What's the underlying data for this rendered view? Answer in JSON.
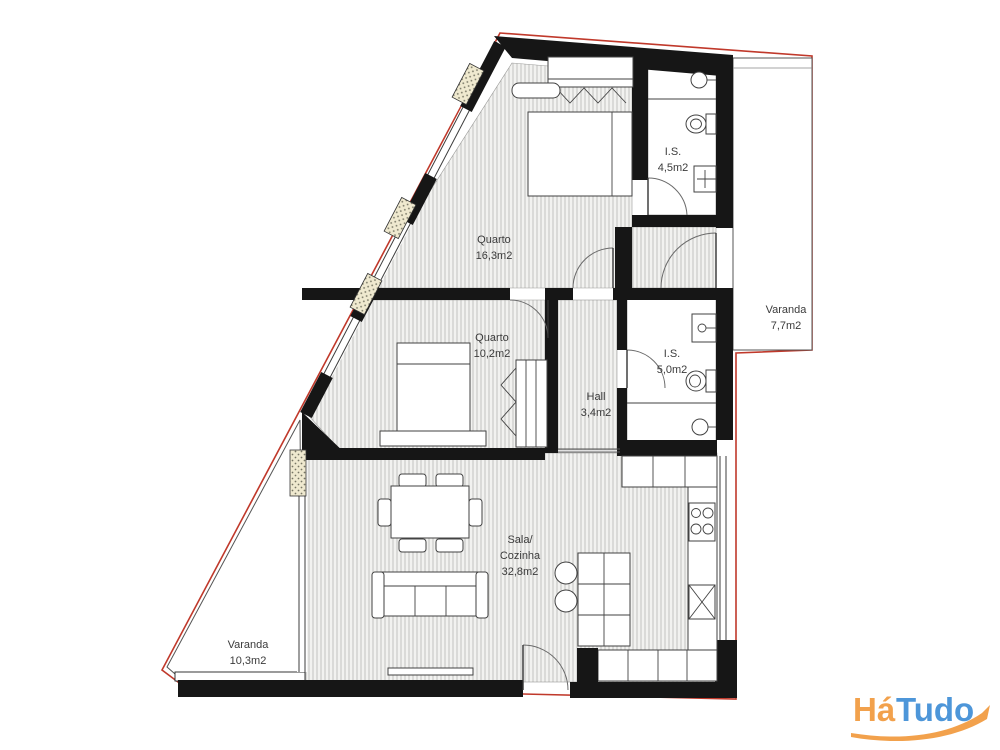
{
  "floor_plan": {
    "rooms": [
      {
        "id": "quarto-1",
        "name": "Quarto",
        "area": "16,3m2"
      },
      {
        "id": "is-1",
        "name": "I.S.",
        "area": "4,5m2"
      },
      {
        "id": "varanda-1",
        "name": "Varanda",
        "area": "7,7m2"
      },
      {
        "id": "quarto-2",
        "name": "Quarto",
        "area": "10,2m2"
      },
      {
        "id": "hall",
        "name": "Hall",
        "area": "3,4m2"
      },
      {
        "id": "is-2",
        "name": "I.S.",
        "area": "5,0m2"
      },
      {
        "id": "sala",
        "name": "Sala/",
        "name2": "Cozinha",
        "area": "32,8m2"
      },
      {
        "id": "varanda-2",
        "name": "Varanda",
        "area": "10,3m2"
      }
    ]
  },
  "watermark": {
    "part1": "Há",
    "part2": "Tudo"
  },
  "colors": {
    "boundary": "#c0392b",
    "logo_orange": "#F2A14C",
    "logo_blue": "#4D96D9"
  }
}
